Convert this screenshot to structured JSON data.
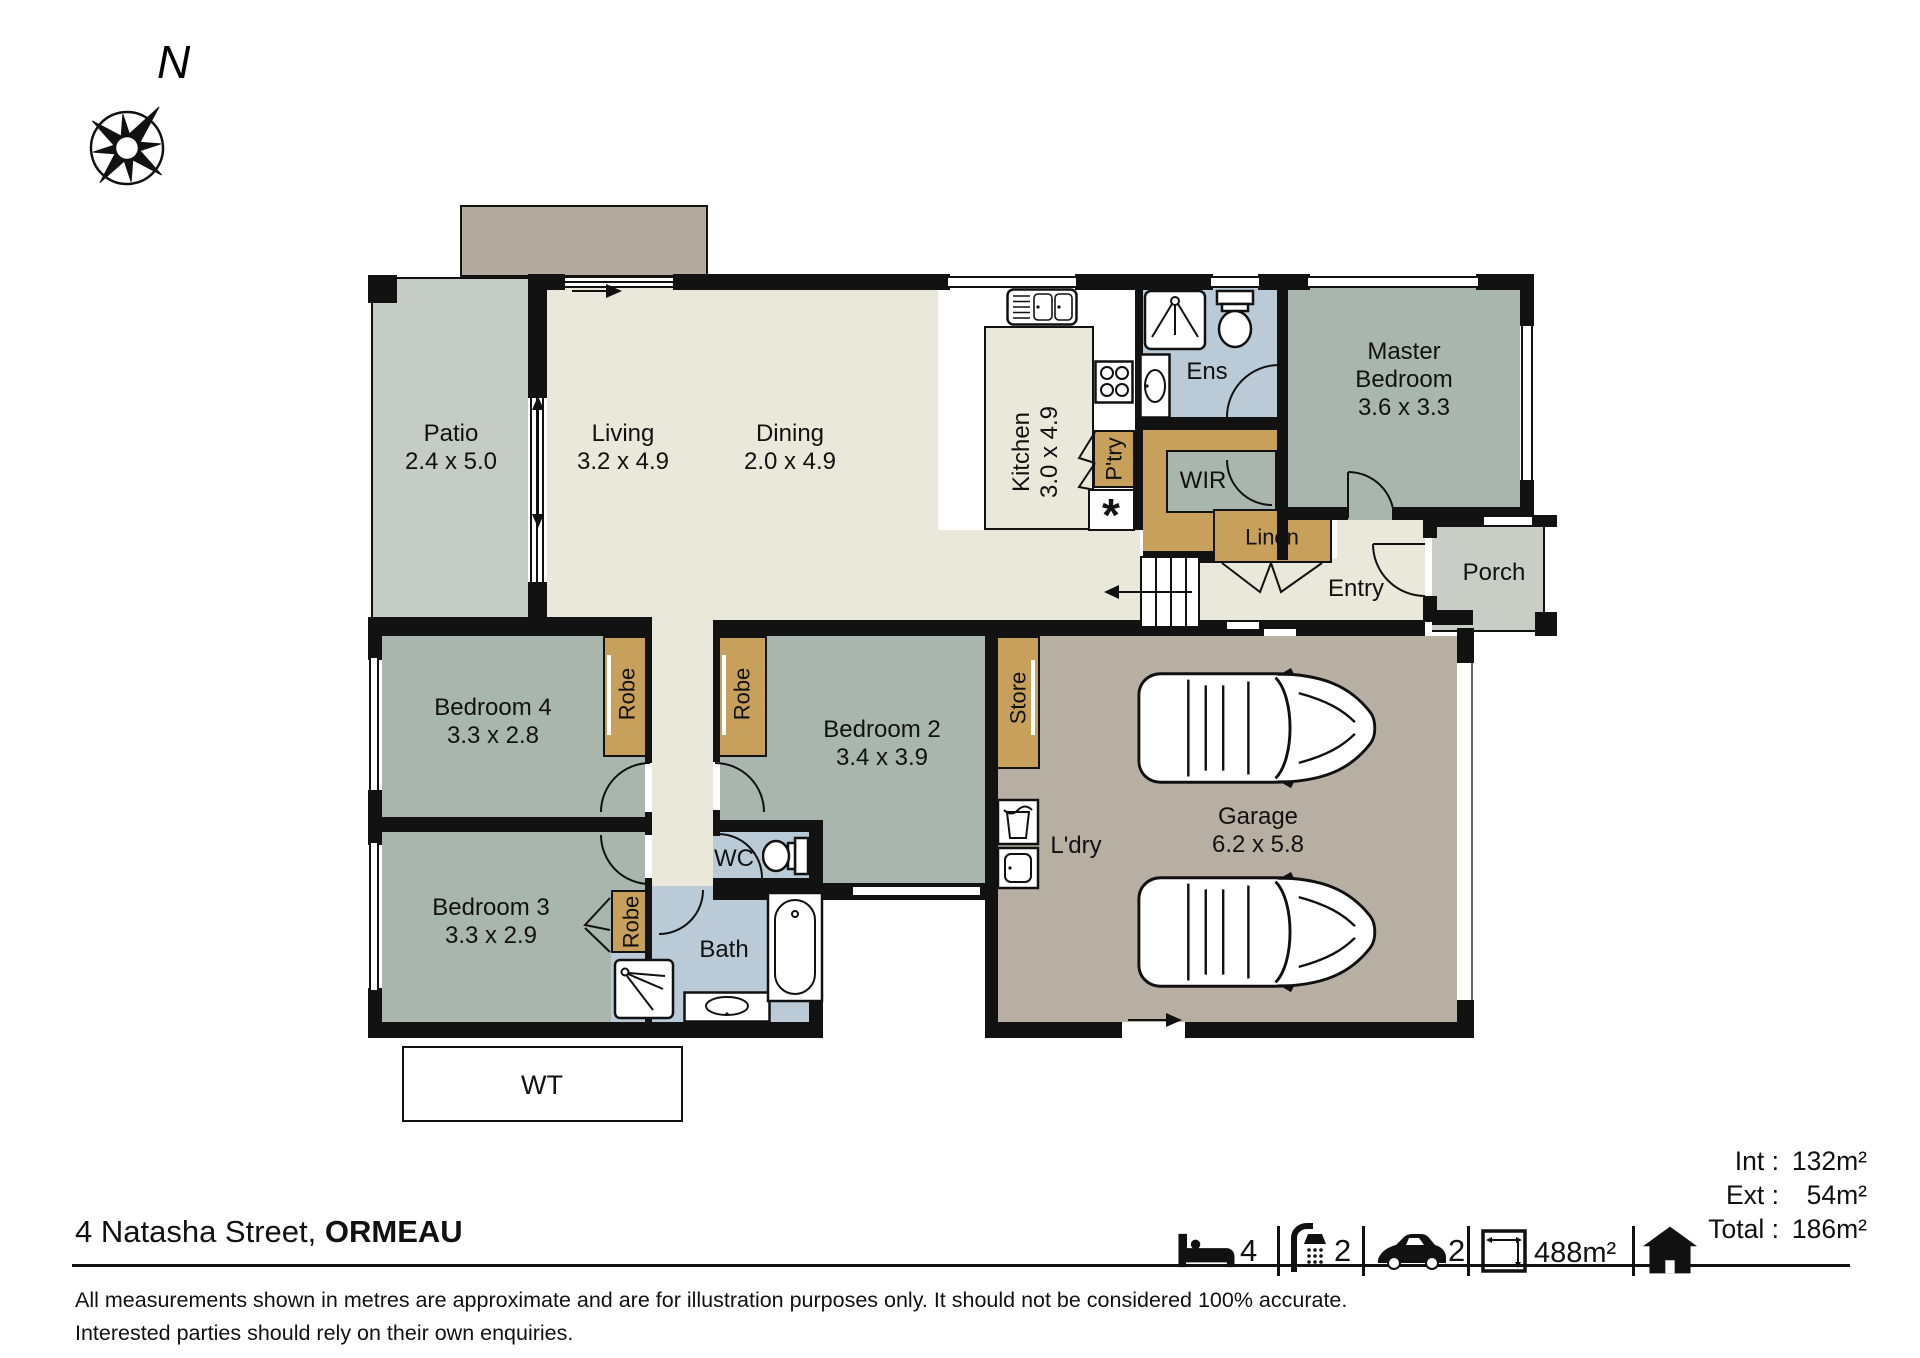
{
  "compass": {
    "north": "N"
  },
  "colors": {
    "wall": "#121212",
    "cream": "#e9e8da",
    "green": "#a9b6ae",
    "blue": "#bacbd7",
    "tan": "#c7a15c",
    "garage": "#b7afa1",
    "patio": "#c5ccc5",
    "porch": "#c9cdc6",
    "ext": "#b3a99c",
    "white": "#ffffff"
  },
  "rooms": {
    "patio": {
      "name": "Patio",
      "dims": "2.4 x 5.0"
    },
    "living": {
      "name": "Living",
      "dims": "3.2 x 4.9"
    },
    "dining": {
      "name": "Dining",
      "dims": "2.0 x 4.9"
    },
    "kitchen": {
      "name": "Kitchen",
      "dims": "3.0 x 4.9"
    },
    "pantry": {
      "name": "P'try"
    },
    "ens": {
      "name": "Ens"
    },
    "wir": {
      "name": "WIR"
    },
    "linen": {
      "name": "Linen"
    },
    "entry": {
      "name": "Entry"
    },
    "porch": {
      "name": "Porch"
    },
    "master": {
      "line1": "Master",
      "line2": "Bedroom",
      "dims": "3.6 x 3.3"
    },
    "bed2": {
      "name": "Bedroom 2",
      "dims": "3.4 x 3.9"
    },
    "bed3": {
      "name": "Bedroom 3",
      "dims": "3.3 x 2.9"
    },
    "bed4": {
      "name": "Bedroom 4",
      "dims": "3.3 x 2.8"
    },
    "garage": {
      "name": "Garage",
      "dims": "6.2 x 5.8"
    },
    "laundry": {
      "name": "L'dry"
    },
    "wc": {
      "name": "WC"
    },
    "bath": {
      "name": "Bath"
    },
    "store": {
      "name": "Store"
    },
    "robe": {
      "name": "Robe"
    },
    "wt": {
      "name": "WT"
    },
    "note_symbol": "*"
  },
  "footer": {
    "address": "4 Natasha Street,",
    "suburb": "ORMEAU",
    "disclaimer_line1": "All measurements shown in metres are approximate and are for illustration purposes only. It should not be considered 100% accurate.",
    "disclaimer_line2": "Interested parties should rely on their own enquiries."
  },
  "legend": {
    "beds": "4",
    "baths": "2",
    "cars": "2",
    "land": "488m²"
  },
  "areas": {
    "int_label": "Int :",
    "int_value": "132m²",
    "ext_label": "Ext :",
    "ext_value": "54m²",
    "total_label": "Total :",
    "total_value": "186m²"
  }
}
